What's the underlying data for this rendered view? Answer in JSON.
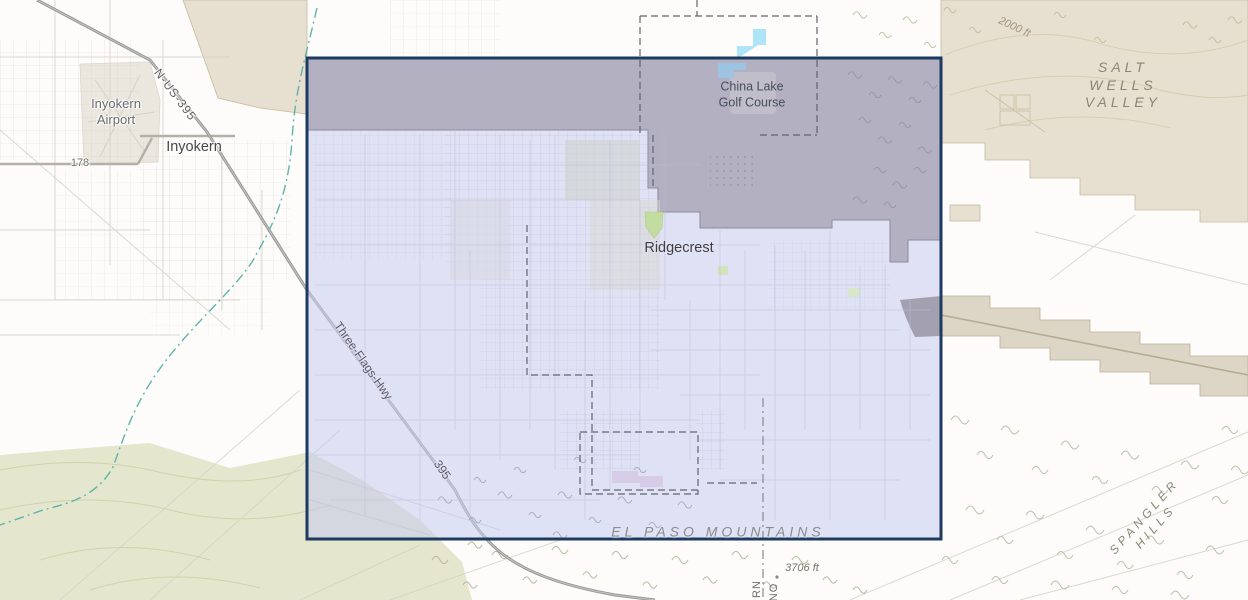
{
  "map": {
    "labels": {
      "airport": "Inyokern\nAirport",
      "inyokern": "Inyokern",
      "route_178": "178",
      "n_us_395": "N-US-395",
      "salt_wells": "SALT WELLS\nVALLEY",
      "contour_2000": "2000 ft",
      "golf_course": "China Lake\nGolf Course",
      "ridgecrest": "Ridgecrest",
      "three_flags": "Three-Flags-Hwy",
      "route_395": "395",
      "el_paso": "EL PASO MOUNTAINS",
      "elev_3706": "3706 ft",
      "spangler": "SPANGLER HILLS",
      "county_left": "RN",
      "county_right": "NO"
    },
    "colors": {
      "selection_border": "#1d3a60",
      "selection_fill": "#c7cbee",
      "military_gray": "#b2b0c1",
      "desert_tan": "#e7dfcf",
      "water_blue": "#ade4f7",
      "park_green": "#c2dd9f",
      "terrain_olive": "#e4e7cd"
    }
  }
}
